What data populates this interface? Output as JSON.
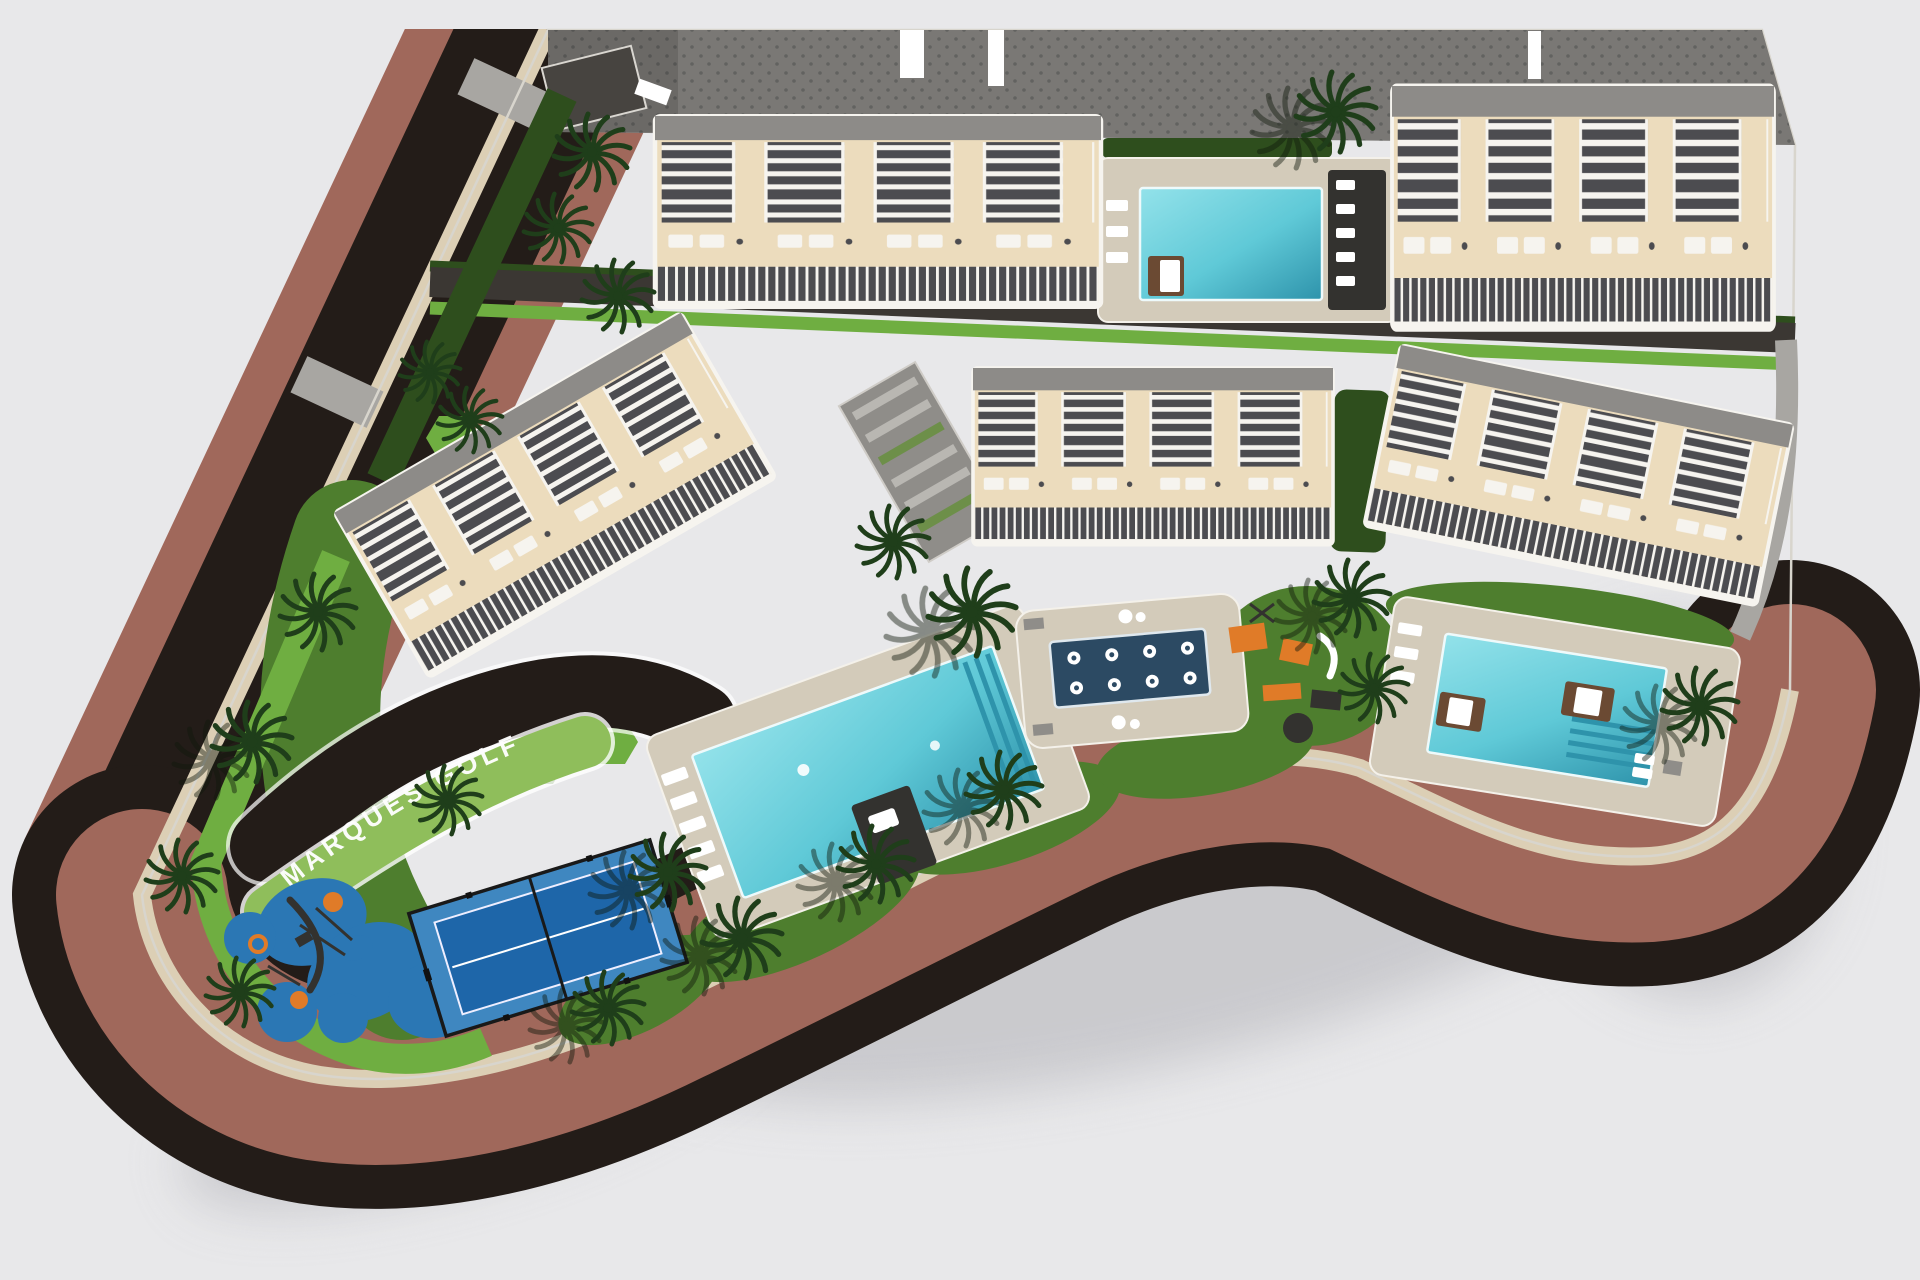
{
  "scene": {
    "kind": "aerial-3d-site-plan-render",
    "road_label": "MARQUES GOLF"
  },
  "site": {
    "residential_blocks": 5,
    "swimming_pools": 3,
    "hydromassage_pool_jets": 8,
    "paddle_courts": 1,
    "playgrounds": 2,
    "communal_buildings": 1
  },
  "colors": {
    "bg": "#e8e8ea",
    "shadow": "#c5c5c9",
    "asphalt": "#231c18",
    "terracotta": "#a0685b",
    "curb": "#dccfb5",
    "paving": "#9b9a97",
    "paving_dot": "#8b8a87",
    "parking": "#7a7875",
    "parking_dot": "#626260",
    "road_inner": "#3b3733",
    "grass": "#4e7e2e",
    "grass_bright": "#6fae41",
    "hedge_dark": "#2e4e1d",
    "hedge_light": "#8fbe5b",
    "palm": "#1f3e1a",
    "palm_shadow": "#10190d",
    "cream": "#ecdcbd",
    "bwhite": "#f6f4ef",
    "bdark": "#4c4c50",
    "roof": "#8d8b88",
    "roof_dark": "#474440",
    "deck": "#d3cbba",
    "pool_light": "#93e2ea",
    "pool_main": "#5fc9d7",
    "pool_deep": "#2e93ab",
    "spa": "#2c4a63",
    "court_light": "#3f87c0",
    "court_dark": "#1e66a9",
    "play_blue": "#2b77b4",
    "orange": "#e07b28",
    "daybed": "#6b4a33",
    "equip_dark": "#33322f",
    "planter": "#8f8d89",
    "paving2": "#a8a6a2",
    "white": "#ffffff",
    "label": "#ffffff"
  }
}
